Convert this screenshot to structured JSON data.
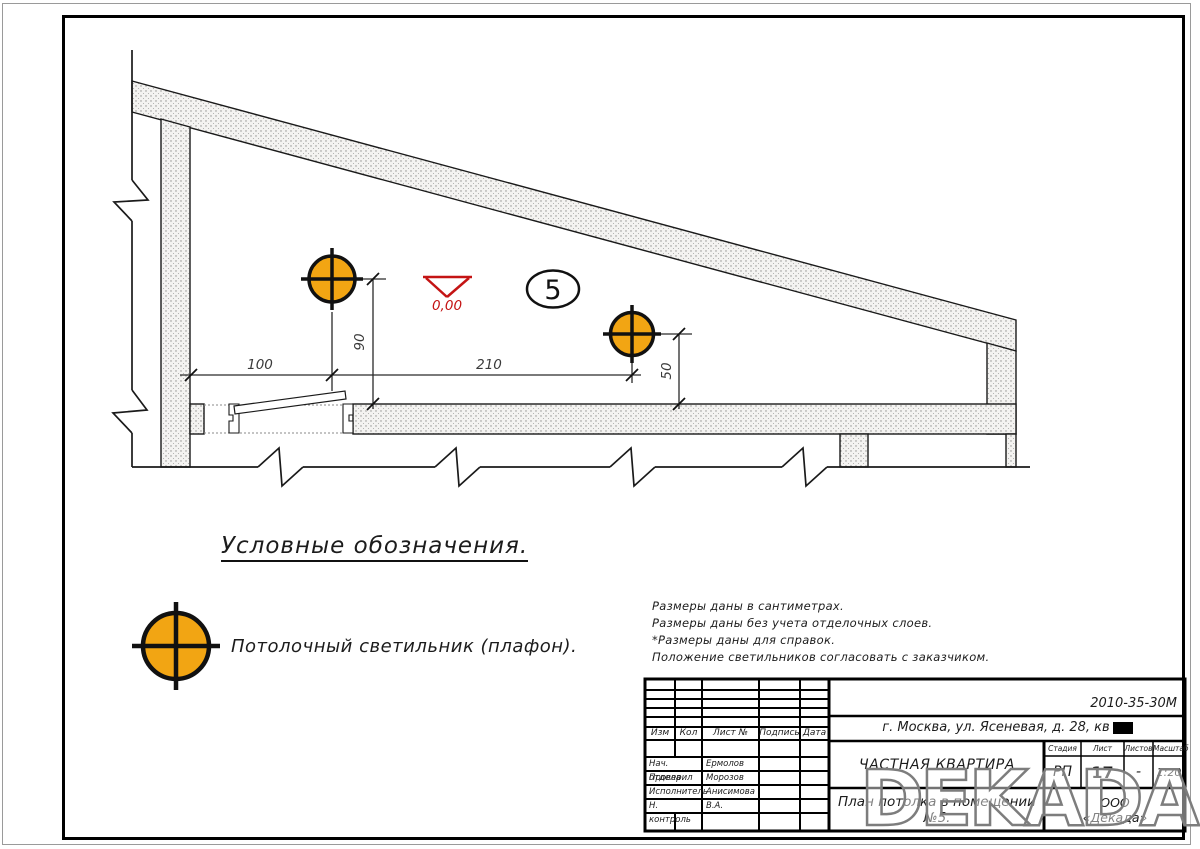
{
  "drawing": {
    "dimensions": {
      "horizontal_1": "100",
      "horizontal_2": "210",
      "vertical_1": "90",
      "vertical_2": "50"
    },
    "level_mark_value": "0,00",
    "room_number": "5",
    "lamp_color": "#F2A513",
    "level_mark_color": "#C41414"
  },
  "legend": {
    "heading": "Условные обозначения.",
    "light_label": "Потолочный светильник (плафон)."
  },
  "notes": [
    "Размеры даны в сантиметрах.",
    "Размеры даны без учета отделочных слоев.",
    "*Размеры даны для справок.",
    "Положение светильников согласовать с заказчиком."
  ],
  "titleblock": {
    "doc_number": "2010-35-30М",
    "address": "г. Москва, ул. Ясеневая, д. 28, кв",
    "project": "ЧАСТНАЯ КВАРТИРА",
    "sheet_title": "План потолка в помещении №5.",
    "company_line1": "ООО",
    "company_line2": "«Декада»",
    "stage_label": "Стадия",
    "sheet_label": "Лист",
    "sheets_label": "Листов",
    "scale_label": "Масштаб",
    "stage_value": "РП",
    "sheet_value": "17",
    "sheets_value": "-",
    "scale_value": "1:20",
    "columns": {
      "izm": "Изм",
      "kol": "Кол",
      "list": "Лист №",
      "podpis": "Подпись",
      "data": "Дата"
    },
    "roles": [
      {
        "label": "Нач. отдела",
        "name": "Ермолов"
      },
      {
        "label": "Проверил",
        "name": "Морозов"
      },
      {
        "label": "Исполнитель",
        "name": "Анисимова В.А."
      },
      {
        "label": "Н. контроль",
        "name": ""
      }
    ]
  },
  "watermark": "DEKADA"
}
